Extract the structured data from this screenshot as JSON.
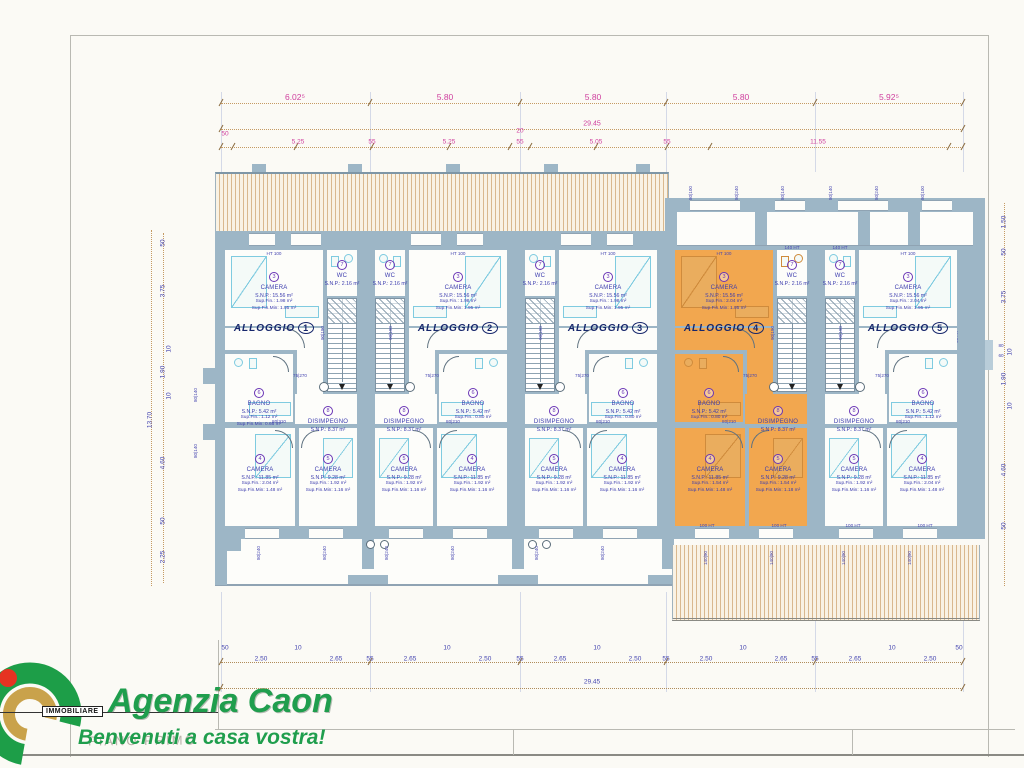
{
  "page": {
    "floor_note": "PIANO PRIMO"
  },
  "logo": {
    "brand_small": "IMMOBILIARE",
    "name": "Agenzia Caon",
    "tagline": "Benvenuti a casa vostra!"
  },
  "colors": {
    "wall": "#9db6c6",
    "orange": "#f2a74f",
    "navy": "#16266b",
    "magenta": "#cf3f9e",
    "dim_blue": "#4545b0",
    "furniture_cyan": "#7fcbe0",
    "logo_green": "#1f9e4d",
    "logo_gold": "#c9a24b",
    "logo_red": "#e63322"
  },
  "top_dims": {
    "segments": [
      "6.02⁵",
      "5.80",
      "5.80",
      "5.80",
      "5.92⁵"
    ],
    "total": "29.45",
    "sub": [
      "50",
      "5.25",
      "55",
      "5.25",
      "20",
      "55",
      "5.05",
      "55",
      "11.55"
    ]
  },
  "bottom_dims": {
    "small": [
      "50",
      "10",
      "10",
      "10",
      "10",
      "10",
      "50"
    ],
    "values": [
      "2.50",
      "2.65",
      "55",
      "2.65",
      "2.50",
      "55",
      "2.65",
      "2.50",
      "55",
      "2.50",
      "2.65",
      "55",
      "2.65",
      "2.50"
    ],
    "total": "29.45"
  },
  "left_dims": {
    "values": [
      "50",
      "3.75",
      "10",
      "1.90",
      "10",
      "4.60",
      "50",
      "2.25"
    ],
    "total": "13.70"
  },
  "right_dims": {
    "values": [
      "1.50",
      "50",
      "3.75",
      "10",
      "1.90",
      "10",
      "4.60",
      "50"
    ],
    "extra": [
      "90 HT",
      "80",
      "60"
    ]
  },
  "wall_labels": {
    "ht100": "HT 100",
    "ht100b": "100 HT",
    "ht140": "140 HT",
    "d75270": "75|270",
    "d80210": "80|210",
    "d80240": "80|240",
    "d90190": "90|190",
    "d14090": "140|90",
    "d80140": "80|140",
    "d80100": "80|100",
    "d80140l": "80|140"
  },
  "units": [
    {
      "label": "ALLOGGIO",
      "number": "1",
      "stairs_side": "right",
      "highlighted": false,
      "camera3": {
        "num": "3",
        "name": "CAMERA",
        "lines": [
          "S.N.P.: 15.56 m²",
          "Sup.Fin.: 1.98 m²",
          "Sup.Fin.Min: 1.95 m²"
        ]
      },
      "wc": {
        "num": "7",
        "name": "WC",
        "lines": [
          "S.N.P.: 2.16 m²"
        ]
      },
      "bagno": {
        "num": "6",
        "name": "BAGNO",
        "lines": [
          "S.N.P.: 5.42 m²",
          "Sup.Fin.: 1.12 m²",
          "Sup.Fin.Min: 0.66 m²"
        ]
      },
      "disimpegno": {
        "num": "8",
        "name": "DISIMPEGNO",
        "lines": [
          "S.N.P.: 8.37 m²"
        ]
      },
      "camera4": {
        "num": "4",
        "name": "CAMERA",
        "lines": [
          "S.N.P.: 11.85 m²",
          "Sup.Fin.: 2.04 m²",
          "Sup.Fin.Min: 1.48 m²"
        ]
      },
      "camera5": {
        "num": "5",
        "name": "CAMERA",
        "lines": [
          "S.N.P.: 9.28 m²",
          "Sup.Fin.: 1.92 m²",
          "Sup.Fin.Min: 1.16 m²"
        ]
      }
    },
    {
      "label": "ALLOGGIO",
      "number": "2",
      "stairs_side": "left",
      "highlighted": false,
      "camera3": {
        "num": "3",
        "name": "CAMERA",
        "lines": [
          "S.N.P.: 15.56 m²",
          "Sup.Fin.: 1.98 m²",
          "Sup.Fin.Min: 1.95 m²"
        ]
      },
      "wc": {
        "num": "7",
        "name": "WC",
        "lines": [
          "S.N.P.: 2.16 m²"
        ]
      },
      "bagno": {
        "num": "6",
        "name": "BAGNO",
        "lines": [
          "S.N.P.: 5.42 m²",
          "Sup.Fin.: 0.80 m²"
        ]
      },
      "disimpegno": {
        "num": "8",
        "name": "DISIMPEGNO",
        "lines": [
          "S.N.P.: 8.37 m²"
        ]
      },
      "camera4": {
        "num": "4",
        "name": "CAMERA",
        "lines": [
          "S.N.P.: 11.85 m²",
          "Sup.Fin.: 1.92 m²",
          "Sup.Fin.Min: 1.16 m²"
        ]
      },
      "camera5": {
        "num": "5",
        "name": "CAMERA",
        "lines": [
          "S.N.P.: 9.28 m²",
          "Sup.Fin.: 1.92 m²",
          "Sup.Fin.Min: 1.16 m²"
        ]
      }
    },
    {
      "label": "ALLOGGIO",
      "number": "3",
      "stairs_side": "left",
      "highlighted": false,
      "camera3": {
        "num": "3",
        "name": "CAMERA",
        "lines": [
          "S.N.P.: 15.56 m²",
          "Sup.Fin.: 1.98 m²",
          "Sup.Fin.Min: 1.95 m²"
        ]
      },
      "wc": {
        "num": "7",
        "name": "WC",
        "lines": [
          "S.N.P.: 2.16 m²"
        ]
      },
      "bagno": {
        "num": "6",
        "name": "BAGNO",
        "lines": [
          "S.N.P.: 5.42 m²",
          "Sup.Fin.: 0.80 m²"
        ]
      },
      "disimpegno": {
        "num": "8",
        "name": "DISIMPEGNO",
        "lines": [
          "S.N.P.: 8.37 m²"
        ]
      },
      "camera4": {
        "num": "4",
        "name": "CAMERA",
        "lines": [
          "S.N.P.: 11.85 m²",
          "Sup.Fin.: 1.92 m²",
          "Sup.Fin.Min: 1.16 m²"
        ]
      },
      "camera5": {
        "num": "5",
        "name": "CAMERA",
        "lines": [
          "S.N.P.: 9.28 m²",
          "Sup.Fin.: 1.92 m²",
          "Sup.Fin.Min: 1.16 m²"
        ]
      }
    },
    {
      "label": "ALLOGGIO",
      "number": "4",
      "stairs_side": "right",
      "highlighted": true,
      "camera3": {
        "num": "3",
        "name": "CAMERA",
        "lines": [
          "S.N.P.: 15.56 m²",
          "Sup.Fin.: 2.04 m²",
          "Sup.Fin.Min: 1.95 m²"
        ]
      },
      "wc": {
        "num": "7",
        "name": "WC",
        "lines": [
          "S.N.P.: 2.16 m²"
        ]
      },
      "bagno": {
        "num": "6",
        "name": "BAGNO",
        "lines": [
          "S.N.P.: 5.42 m²",
          "Sup.Fin.: 0.80 m²"
        ]
      },
      "disimpegno": {
        "num": "8",
        "name": "DISIMPEGNO",
        "lines": [
          "S.N.P.: 8.37 m²"
        ]
      },
      "camera4": {
        "num": "4",
        "name": "CAMERA",
        "lines": [
          "S.N.P.: 11.85 m²",
          "Sup.Fin.: 1.54 m²",
          "Sup.Fin.Min: 1.48 m²"
        ]
      },
      "camera5": {
        "num": "5",
        "name": "CAMERA",
        "lines": [
          "S.N.P.: 9.28 m²",
          "Sup.Fin.: 1.54 m²",
          "Sup.Fin.Min: 1.18 m²"
        ]
      }
    },
    {
      "label": "ALLOGGIO",
      "number": "5",
      "stairs_side": "left",
      "highlighted": false,
      "camera3": {
        "num": "3",
        "name": "CAMERA",
        "lines": [
          "S.N.P.: 15.56 m²",
          "Sup.Fin.: 2.04 m²",
          "Sup.Fin.Min: 1.95 m²"
        ]
      },
      "wc": {
        "num": "7",
        "name": "WC",
        "lines": [
          "S.N.P.: 2.16 m²"
        ]
      },
      "bagno": {
        "num": "6",
        "name": "BAGNO",
        "lines": [
          "S.N.P.: 5.42 m²",
          "Sup.Fin.: 1.12 m²"
        ]
      },
      "disimpegno": {
        "num": "8",
        "name": "DISIMPEGNO",
        "lines": [
          "S.N.P.: 8.37 m²"
        ]
      },
      "camera4": {
        "num": "4",
        "name": "CAMERA",
        "lines": [
          "S.N.P.: 11.85 m²",
          "Sup.Fin.: 2.04 m²",
          "Sup.Fin.Min: 1.48 m²"
        ]
      },
      "camera5": {
        "num": "5",
        "name": "CAMERA",
        "lines": [
          "S.N.P.: 9.28 m²",
          "Sup.Fin.: 1.92 m²",
          "Sup.Fin.Min: 1.16 m²"
        ]
      }
    }
  ]
}
